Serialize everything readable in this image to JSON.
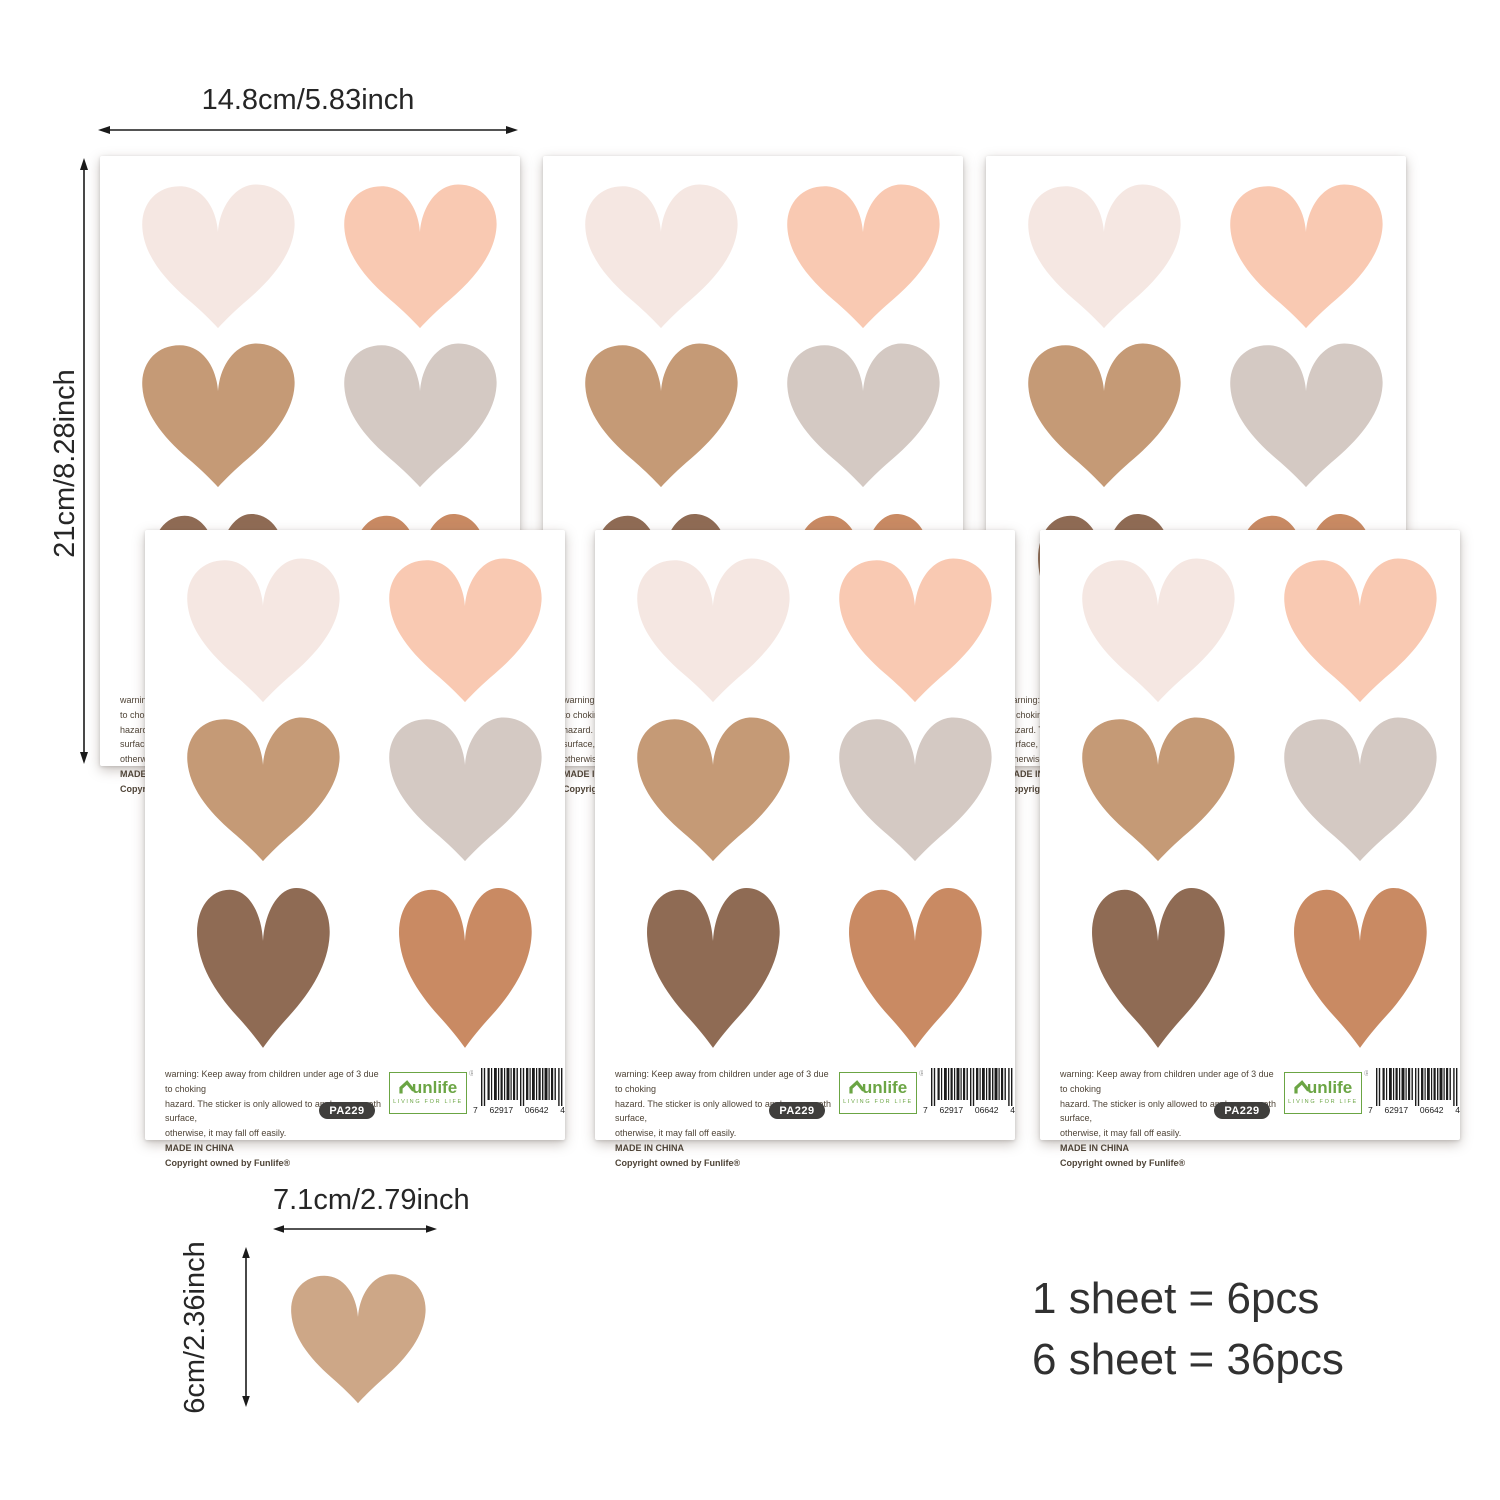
{
  "annotations": {
    "sheet_width_label": "14.8cm/5.83inch",
    "sheet_height_label": "21cm/8.28inch",
    "heart_width_label": "7.1cm/2.79inch",
    "heart_height_label": "6cm/2.36inch",
    "count_line1": "1 sheet = 6pcs",
    "count_line2": "6 sheet = 36pcs"
  },
  "sheet": {
    "warning": [
      "warning: Keep away from children under age of 3 due to choking",
      "hazard. The sticker is only allowed to apply on smooth surface,",
      "otherwise, it may fall off easily."
    ],
    "made_in": "MADE IN CHINA",
    "copyright": "Copyright owned by Funlife®",
    "sku": "PA229",
    "logo": {
      "brand": "unlife",
      "tagline": "LIVING FOR LIFE",
      "registered": "®",
      "color": "#6ba544"
    },
    "barcode": [
      "7",
      "62917",
      "06642",
      "4"
    ]
  },
  "hearts": {
    "colors": {
      "cream": "#f5e7e2",
      "peach": "#f9c9b2",
      "tan": "#c59a76",
      "gray": "#d4c9c3",
      "brown": "#8f6b54",
      "terracotta": "#c98a63",
      "sample": "#cda787"
    },
    "grid": [
      [
        "cream",
        "peach"
      ],
      [
        "tan",
        "gray"
      ],
      [
        "brown",
        "terracotta"
      ]
    ]
  }
}
